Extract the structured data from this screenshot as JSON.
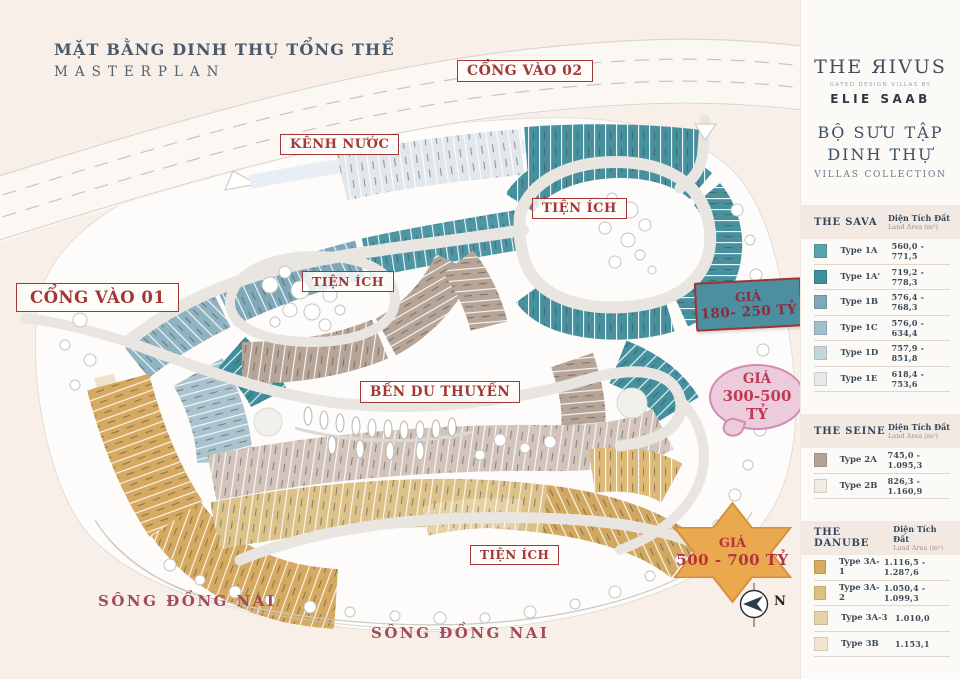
{
  "header": {
    "title_vi": "MẶT BẰNG DINH THỤ TỔNG THỂ",
    "title_en": "MASTERPLAN"
  },
  "map_labels": {
    "gate_02": "CỔNG VÀO 02",
    "gate_01": "CỔNG VÀO 01",
    "canal": "KÊNH NƯỚC",
    "amenity_left": "TIỆN ÍCH",
    "amenity_right": "TIỆN ÍCH",
    "amenity_bottom": "TIỆN ÍCH",
    "marina": "BẾN DU THUYỀN",
    "river_left": "SÔNG ĐỒNG NAI",
    "river_bottom": "SÔNG ĐỒNG NAI",
    "compass_north": "N"
  },
  "price_callouts": {
    "tier1": {
      "label": "GIÁ",
      "range": "180- 250 TỶ",
      "fill": "#4b8fa0"
    },
    "tier2": {
      "label": "GIÁ",
      "range": "300-500 TỶ",
      "fill": "#ebcbdc"
    },
    "tier3": {
      "label": "GIÁ",
      "range": "500 - 700 TỶ",
      "fill": "#eaa94f"
    }
  },
  "brand": {
    "name": "THE ЯIVUS",
    "tagline": "GATED DESIGN VILLAS BY",
    "designer": "ELIE SAAB"
  },
  "collection": {
    "title_line1": "BỘ SƯU TẬP",
    "title_line2": "DINH THỰ",
    "subtitle": "VILLAS COLLECTION"
  },
  "legend": {
    "area_header_vi": "Diện Tích Đất",
    "area_header_en": "Land Area (m²)",
    "sections": [
      {
        "name": "THE SAVA",
        "rows": [
          {
            "type": "Type 1A",
            "area": "560,0 - 771,5",
            "color": "#5ba3ad"
          },
          {
            "type": "Type 1A'",
            "area": "719,2 - 778,3",
            "color": "#3f8d9e"
          },
          {
            "type": "Type 1B",
            "area": "576,4 - 768,3",
            "color": "#7fa9b8"
          },
          {
            "type": "Type 1C",
            "area": "576,0 - 634,4",
            "color": "#a3bfcb"
          },
          {
            "type": "Type 1D",
            "area": "757,9 - 851,8",
            "color": "#c6d6de"
          },
          {
            "type": "Type 1E",
            "area": "618,4 - 753,6",
            "color": "#e4e9ed"
          }
        ]
      },
      {
        "name": "THE SEINE",
        "rows": [
          {
            "type": "Type 2A",
            "area": "745,0 - 1.095,3",
            "color": "#b3a396"
          },
          {
            "type": "Type 2B",
            "area": "826,3 - 1.160,9",
            "color": "#f2eae3"
          }
        ]
      },
      {
        "name": "THE DANUBE",
        "rows": [
          {
            "type": "Type 3A-1",
            "area": "1.116,5 - 1.287,6",
            "color": "#d6ab62"
          },
          {
            "type": "Type 3A-2",
            "area": "1.050,4 - 1.099,3",
            "color": "#dcc084"
          },
          {
            "type": "Type 3A-3",
            "area": "1.010,0",
            "color": "#e6d2a4"
          },
          {
            "type": "Type 3B",
            "area": "1.153,1",
            "color": "#f1e7d0"
          }
        ]
      }
    ]
  }
}
